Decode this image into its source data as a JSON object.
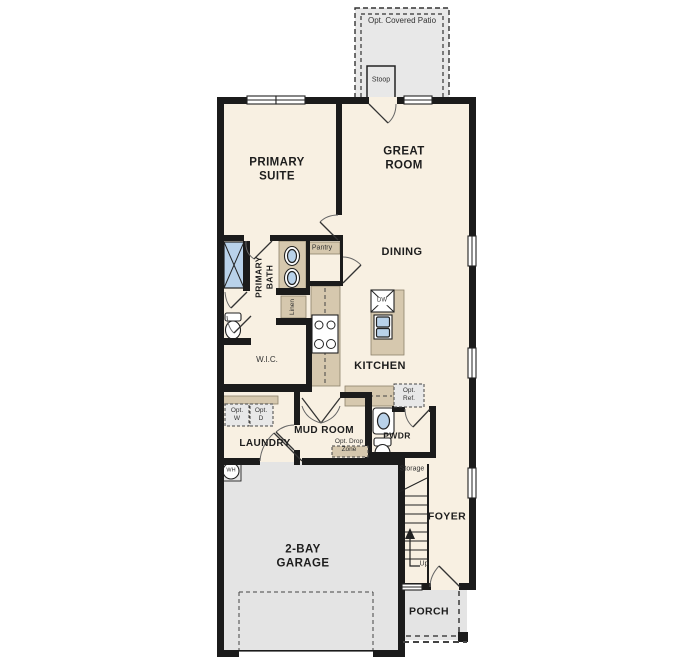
{
  "plan": {
    "type": "single-family house first-floor plan",
    "labels": {
      "opt_covered_patio": "Opt. Covered Patio",
      "stoop": "Stoop",
      "primary_suite": "PRIMARY\nSUITE",
      "great_room": "GREAT\nROOM",
      "dining": "DINING",
      "kitchen": "KITCHEN",
      "primary_bath": "PRIMARY\nBATH",
      "pantry": "Pantry",
      "linen": "Linen",
      "wic": "W.I.C.",
      "dw": "DW",
      "laundry": "LAUNDRY",
      "opt_w": "Opt.\nW",
      "opt_d": "Opt.\nD",
      "mud_room": "MUD ROOM",
      "opt_drop_zone": "Opt. Drop\nZone",
      "pwdr": "PWDR",
      "opt_ref": "Opt.\nRef.",
      "storage": "Storage",
      "foyer": "FOYER",
      "up": "Up",
      "garage": "2-BAY\nGARAGE",
      "porch": "PORCH",
      "wh": "WH"
    },
    "colors": {
      "floor": "#f8f0e2",
      "garage_floor": "#e4e4e4",
      "wall": "#1b1b1b",
      "cabinet": "#d6c8ae",
      "fixture_blue": "#b9d2ea",
      "optional_fill": "#e8e8e8"
    }
  }
}
